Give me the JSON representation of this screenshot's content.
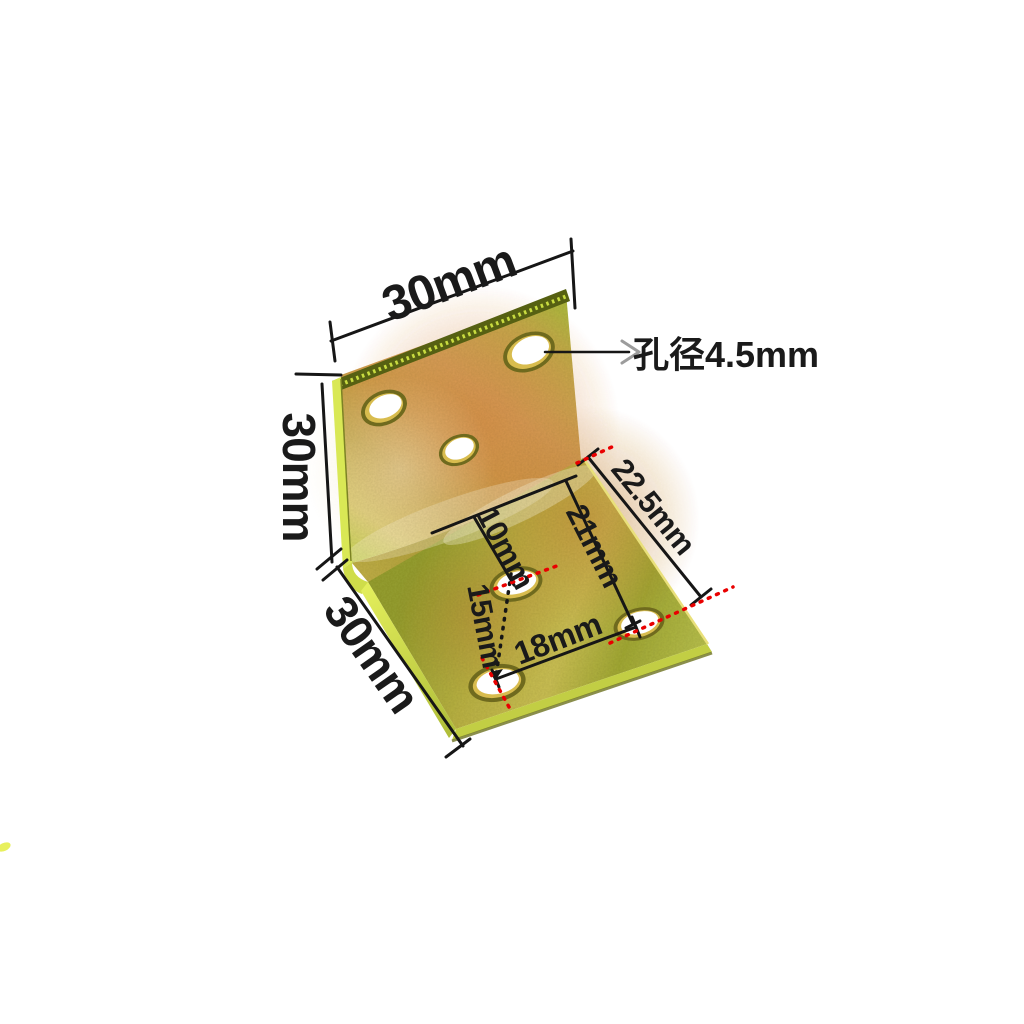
{
  "diagram": {
    "subject": "corner-bracket-dimension-diagram",
    "labels": {
      "top_width": "30mm",
      "left_height": "30mm",
      "bottom_depth": "30mm",
      "hole_diameter": "孔径4.5mm",
      "edge_offset": "22.5mm",
      "fold_to_corner_hole": "21mm",
      "fold_to_center_hole": "10mm",
      "center_to_corner_hole": "15mm",
      "corner_hole_span": "18mm"
    },
    "colors": {
      "dimension_line": "#161616",
      "reference_red": "#e90000",
      "arrowhead_gray": "#9c9c9c",
      "brass_bright_edge": "#d9e855",
      "brass_gold": "#d0a848",
      "brass_warm": "#d89a55",
      "brass_olive": "#8f992e",
      "edge_dark": "#566012",
      "background": "#ffffff"
    },
    "counts": {
      "holes_vertical_face": 3,
      "holes_horizontal_face": 3
    }
  }
}
